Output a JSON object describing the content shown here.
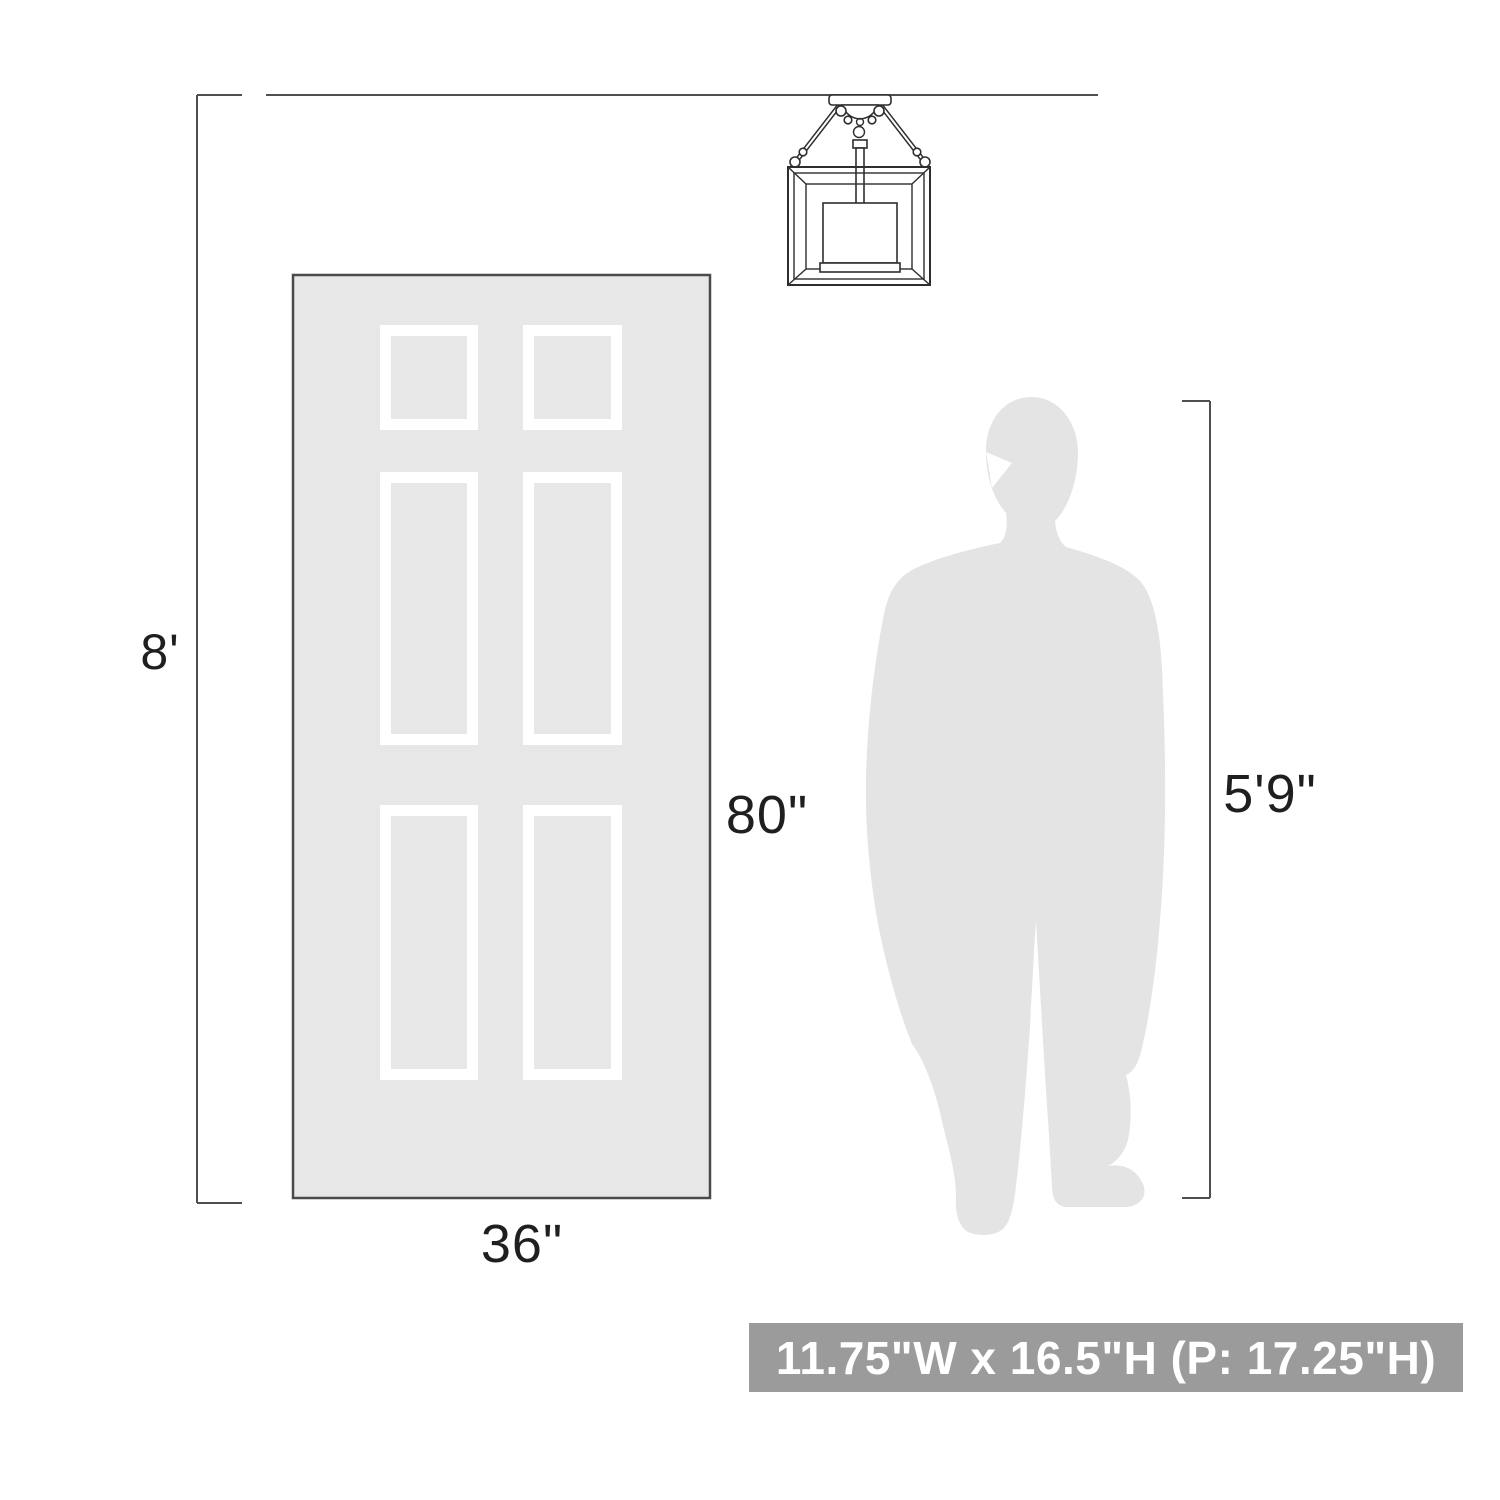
{
  "diagram": {
    "labels": {
      "ceiling_height": "8'",
      "door_height": "80\"",
      "door_width": "36\"",
      "person_height": "5'9\""
    },
    "badge": {
      "fixture_dimensions": "11.75\"W x 16.5\"H (P: 17.25\"H)"
    },
    "icons": {
      "ceiling_light": "ceiling-light-line-drawing-icon",
      "door": "door-silhouette",
      "person": "person-silhouette"
    },
    "colors": {
      "background": "#ffffff",
      "door_fill": "#e7e7e7",
      "door_border": "#4a4a4a",
      "panel_stroke": "#ffffff",
      "person_fill": "#e4e4e4",
      "dimension_line": "#4f4f4f",
      "label_text": "#1f1f1f",
      "badge_background": "#9b9b9b",
      "badge_text": "#ffffff",
      "fixture_line": "#2e2e2e"
    }
  }
}
